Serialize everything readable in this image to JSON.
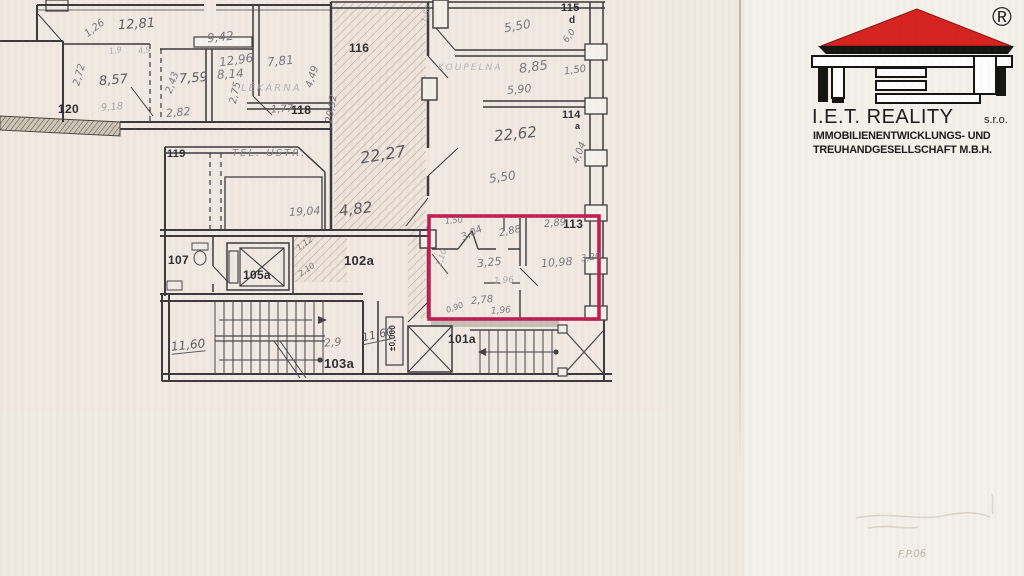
{
  "logo": {
    "registered_mark": "®",
    "company": "I.E.T. REALITY",
    "suffix": "s.r.o.",
    "line2": "IMMOBILIENENTWICKLUNGS- UND",
    "line3": "TREUHANDGESELLSCHAFT M.B.H.",
    "roof_color": "#d6231f"
  },
  "stamp": {
    "text": "F.P.06"
  },
  "plan": {
    "highlight_color": "#c01d54",
    "highlighted_room": "113",
    "room_numbers": [
      {
        "text": "120",
        "x": 58,
        "y": 103,
        "size": 12
      },
      {
        "text": "118",
        "x": 291,
        "y": 104,
        "size": 12
      },
      {
        "text": "119",
        "x": 167,
        "y": 149,
        "size": 11
      },
      {
        "text": "116",
        "x": 349,
        "y": 42,
        "size": 12
      },
      {
        "text": "115",
        "x": 561,
        "y": 3,
        "size": 11
      },
      {
        "text": "d",
        "x": 569,
        "y": 16,
        "size": 10
      },
      {
        "text": "114",
        "x": 562,
        "y": 110,
        "size": 11
      },
      {
        "text": "a",
        "x": 575,
        "y": 122,
        "size": 9
      },
      {
        "text": "113",
        "x": 563,
        "y": 218,
        "size": 12
      },
      {
        "text": "107",
        "x": 168,
        "y": 254,
        "size": 12
      },
      {
        "text": "105a",
        "x": 243,
        "y": 269,
        "size": 12
      },
      {
        "text": "102a",
        "x": 344,
        "y": 254,
        "size": 13
      },
      {
        "text": "103a",
        "x": 324,
        "y": 357,
        "size": 13
      },
      {
        "text": "101a",
        "x": 448,
        "y": 333,
        "size": 12
      },
      {
        "text": "±0,000",
        "x": 380,
        "y": 334,
        "size": 8,
        "rot": -90
      }
    ],
    "measurements": [
      {
        "text": "12,81",
        "x": 118,
        "y": 18,
        "size": 13,
        "rot": -4,
        "dark": true
      },
      {
        "text": "1,26",
        "x": 84,
        "y": 24,
        "size": 10,
        "rot": -38
      },
      {
        "text": "9,42",
        "x": 207,
        "y": 31,
        "size": 12,
        "rot": -6
      },
      {
        "text": "12,96",
        "x": 219,
        "y": 54,
        "size": 12,
        "rot": -8
      },
      {
        "text": "8,14",
        "x": 217,
        "y": 68,
        "size": 12,
        "rot": -4
      },
      {
        "text": "7,81",
        "x": 267,
        "y": 55,
        "size": 12,
        "rot": -6
      },
      {
        "text": "4,49",
        "x": 302,
        "y": 72,
        "size": 10,
        "rot": -72
      },
      {
        "text": "8,57",
        "x": 99,
        "y": 74,
        "size": 13,
        "rot": -5,
        "dark": true
      },
      {
        "text": "2,72",
        "x": 69,
        "y": 70,
        "size": 10,
        "rot": -75
      },
      {
        "text": "7,59",
        "x": 179,
        "y": 72,
        "size": 13,
        "rot": -4,
        "dark": true
      },
      {
        "text": "2,43",
        "x": 162,
        "y": 78,
        "size": 10,
        "rot": -70
      },
      {
        "text": "2,75",
        "x": 225,
        "y": 88,
        "size": 10,
        "rot": -78
      },
      {
        "text": "1,77",
        "x": 271,
        "y": 105,
        "size": 10,
        "rot": -3
      },
      {
        "text": "2,82",
        "x": 166,
        "y": 107,
        "size": 11,
        "rot": -5
      },
      {
        "text": "9,18",
        "x": 101,
        "y": 103,
        "size": 10,
        "rot": -4,
        "faint": true
      },
      {
        "text": "1,9",
        "x": 109,
        "y": 47,
        "size": 8,
        "rot": -8,
        "faint": true
      },
      {
        "text": "4,9",
        "x": 138,
        "y": 47,
        "size": 8,
        "rot": -8,
        "faint": true
      },
      {
        "text": "1,50",
        "x": 418,
        "y": 10,
        "size": 8,
        "rot": -75,
        "faint": true
      },
      {
        "text": "22,27",
        "x": 360,
        "y": 147,
        "size": 16,
        "rot": -9,
        "dark": true
      },
      {
        "text": "4,82",
        "x": 339,
        "y": 202,
        "size": 15,
        "rot": -7,
        "dark": true
      },
      {
        "text": "19,04",
        "x": 289,
        "y": 206,
        "size": 11,
        "rot": -3
      },
      {
        "text": "20,92",
        "x": 318,
        "y": 104,
        "size": 10,
        "rot": -80
      },
      {
        "text": "5,50",
        "x": 504,
        "y": 20,
        "size": 12,
        "rot": -10
      },
      {
        "text": "6,0",
        "x": 563,
        "y": 32,
        "size": 9,
        "rot": -55
      },
      {
        "text": "8,85",
        "x": 519,
        "y": 61,
        "size": 13,
        "rot": -8
      },
      {
        "text": "1,50",
        "x": 564,
        "y": 66,
        "size": 10,
        "rot": -8
      },
      {
        "text": "5,90",
        "x": 507,
        "y": 84,
        "size": 11,
        "rot": -5
      },
      {
        "text": "22,62",
        "x": 494,
        "y": 127,
        "size": 15,
        "rot": -6,
        "dark": true
      },
      {
        "text": "5,50",
        "x": 489,
        "y": 171,
        "size": 12,
        "rot": -8
      },
      {
        "text": "4,04",
        "x": 569,
        "y": 148,
        "size": 10,
        "rot": -68
      },
      {
        "text": "1,50",
        "x": 445,
        "y": 217,
        "size": 8,
        "rot": -5
      },
      {
        "text": "3,04",
        "x": 461,
        "y": 229,
        "size": 10,
        "rot": -25
      },
      {
        "text": "2,88",
        "x": 499,
        "y": 227,
        "size": 10,
        "rot": -12
      },
      {
        "text": "2,89",
        "x": 544,
        "y": 219,
        "size": 10,
        "rot": -6
      },
      {
        "text": "1,10",
        "x": 433,
        "y": 254,
        "size": 8,
        "rot": -70,
        "faint": true
      },
      {
        "text": "3,25",
        "x": 477,
        "y": 257,
        "size": 11,
        "rot": -6
      },
      {
        "text": "10,98",
        "x": 541,
        "y": 257,
        "size": 11,
        "rot": -4
      },
      {
        "text": "3,20",
        "x": 581,
        "y": 254,
        "size": 9,
        "rot": -8
      },
      {
        "text": "1,96",
        "x": 494,
        "y": 277,
        "size": 9,
        "rot": -4,
        "faint": true
      },
      {
        "text": "2,78",
        "x": 471,
        "y": 296,
        "size": 10,
        "rot": -6
      },
      {
        "text": "0,90",
        "x": 446,
        "y": 304,
        "size": 8,
        "rot": -20
      },
      {
        "text": "1,96",
        "x": 491,
        "y": 307,
        "size": 9,
        "rot": -4
      },
      {
        "text": "1,12",
        "x": 296,
        "y": 240,
        "size": 8,
        "rot": -35
      },
      {
        "text": "2,10",
        "x": 298,
        "y": 266,
        "size": 8,
        "rot": -35
      },
      {
        "text": "11,60",
        "x": 362,
        "y": 329,
        "size": 11,
        "rot": -12,
        "dark": true,
        "underline": true
      },
      {
        "text": "2,9",
        "x": 324,
        "y": 337,
        "size": 11,
        "rot": -5
      },
      {
        "text": "11,60",
        "x": 171,
        "y": 339,
        "size": 12,
        "rot": -6,
        "dark": true,
        "underline": true
      }
    ],
    "annotations": [
      {
        "text": "TEL. ÚSTŘ.",
        "x": 232,
        "y": 149,
        "size": 10
      },
      {
        "text": "LÉKÁRNA",
        "x": 241,
        "y": 84,
        "size": 10,
        "faint": true
      },
      {
        "text": "KOUPELNA",
        "x": 438,
        "y": 64,
        "size": 9,
        "faint": true
      }
    ]
  }
}
